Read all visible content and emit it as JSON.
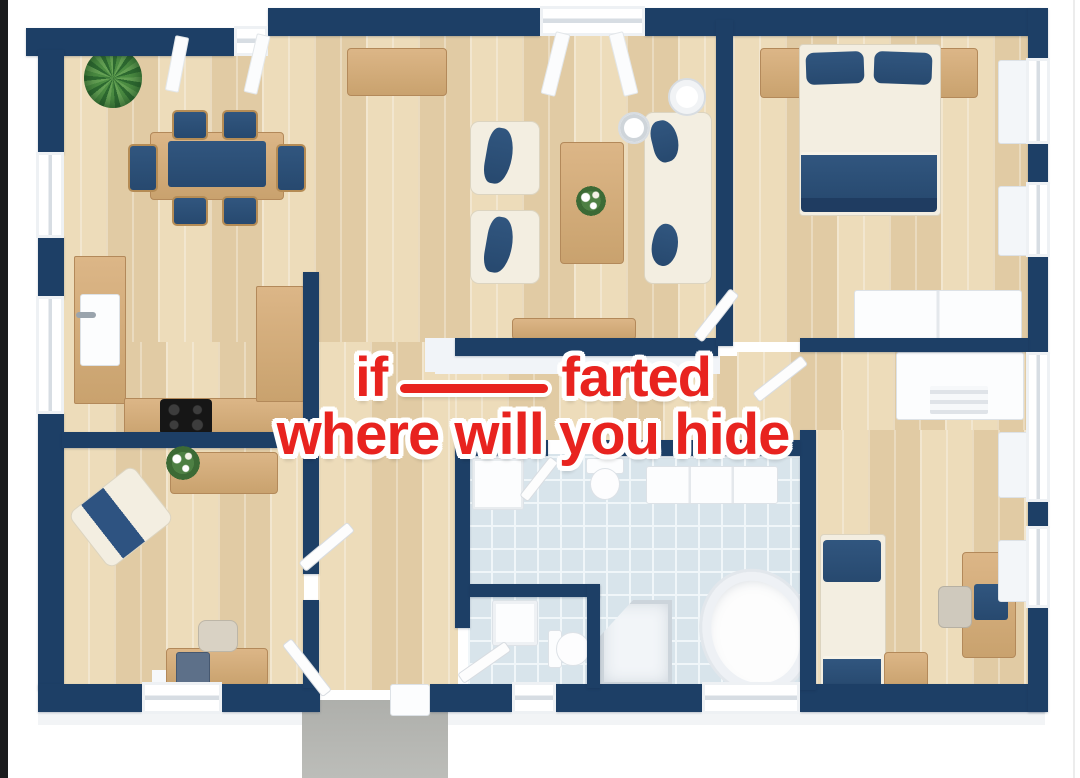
{
  "overlay": {
    "line1": {
      "before": "if",
      "blank": "____",
      "after": "farted"
    },
    "line2": "where will you hide",
    "full_text": "if ____ farted where will you hide",
    "text_color": "#e8231f",
    "outline_color": "#ffffff"
  },
  "palette": {
    "wall_navy": "#1d3f66",
    "floor_wood": "#e7d4b1",
    "furniture_wood": "#d2ab79",
    "fabric_navy": "#2d5180",
    "fabric_cream": "#f3eee1",
    "bathroom_tile": "#d8e4eb",
    "tile_grout": "#f0f6f9",
    "entry_path": "#b5b6b2",
    "background": "#ffffff",
    "edge_bar": "#1a1b1d"
  },
  "floorplan": {
    "style": "3d-top-down-render",
    "rooms": [
      {
        "name": "dining-room",
        "furniture": [
          "potted-plant",
          "dining-table-with-navy-runner",
          "six-dining-chairs",
          "sideboard"
        ]
      },
      {
        "name": "living-room",
        "furniture": [
          "armchair",
          "armchair",
          "coffee-table-with-flowers",
          "sofa-with-navy-pillows",
          "floor-lamp",
          "side-table",
          "tv-console"
        ]
      },
      {
        "name": "kitchen",
        "furniture": [
          "counter-with-sink",
          "counter-with-cooktop",
          "tall-cabinet"
        ]
      },
      {
        "name": "master-bedroom",
        "furniture": [
          "double-bed",
          "nightstand",
          "nightstand",
          "white-dresser"
        ]
      },
      {
        "name": "dressing-room",
        "furniture": [
          "white-wardrobe"
        ]
      },
      {
        "name": "bathroom",
        "furniture": [
          "washer-cabinet",
          "toilet",
          "bench-cabinet",
          "vanity-sink",
          "wc-toilet",
          "corner-shower",
          "oval-bathtub"
        ]
      },
      {
        "name": "second-bedroom",
        "furniture": [
          "single-bed",
          "nightstand",
          "desk",
          "desk-chair"
        ]
      },
      {
        "name": "home-office",
        "furniture": [
          "angled-armchair",
          "sideboard-with-flowers",
          "desk-with-computer",
          "desk-chair"
        ]
      },
      {
        "name": "hallway",
        "furniture": []
      },
      {
        "name": "entry-path",
        "furniture": []
      }
    ]
  }
}
